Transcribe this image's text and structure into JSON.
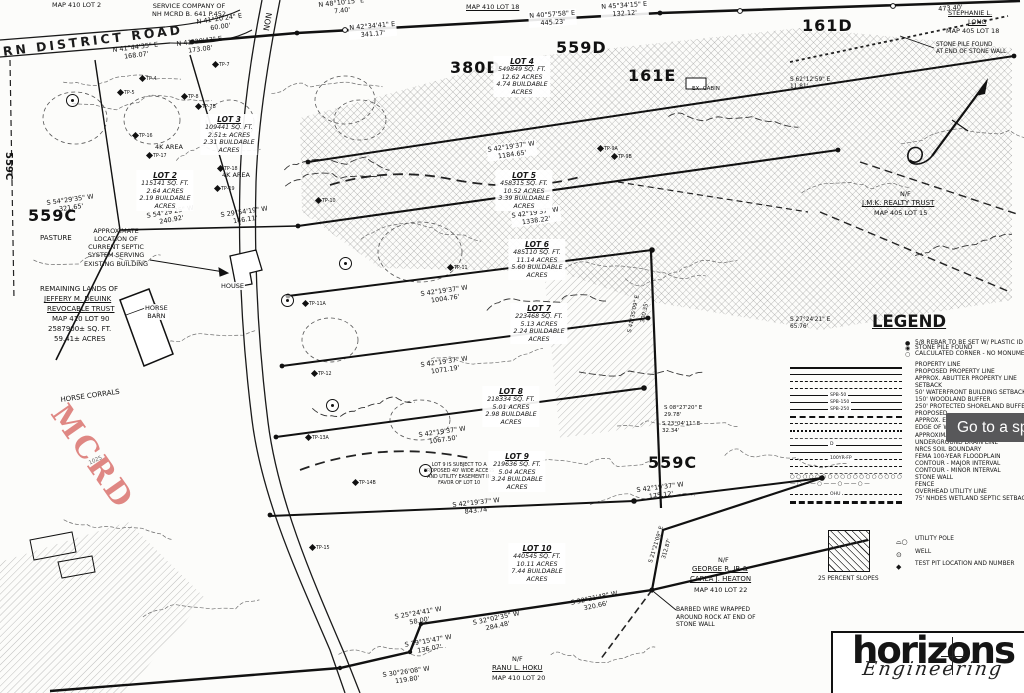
{
  "tooltip": {
    "text": "Go to a spe"
  },
  "watermark": {
    "text": "MCRD",
    "color": "#d96a66"
  },
  "logo": {
    "name": "horizons",
    "tagline": "Engineering"
  },
  "legend": {
    "title": "LEGEND",
    "point_items": [
      {
        "symbol": "rebar-icon",
        "label": "5/8 REBAR TO BE SET W/ PLASTIC ID CAP"
      },
      {
        "symbol": "stone-pile-icon",
        "label": "STONE PILE FOUND"
      },
      {
        "symbol": "calculated-corner-icon",
        "label": "CALCULATED CORNER - NO MONUMENT"
      }
    ],
    "line_items": [
      {
        "style": "property",
        "label": "PROPERTY LINE"
      },
      {
        "style": "proposed-property",
        "label": "PROPOSED PROPERTY LINE"
      },
      {
        "style": "abutter",
        "label": "APPROX. ABUTTER PROPERTY LINE"
      },
      {
        "style": "setback",
        "label": "SETBACK"
      },
      {
        "style": "spb50",
        "tag": "SPB-50",
        "label": "50' WATERFRONT BUILDING SETBACK"
      },
      {
        "style": "spb150",
        "tag": "SPB-150",
        "label": "150' WOODLAND BUFFER"
      },
      {
        "style": "spb250",
        "tag": "SPB-250",
        "label": "250' PROTECTED SHORELAND BUFFER"
      },
      {
        "style": "proposed2",
        "label": "PROPOSED"
      },
      {
        "style": "approx-e",
        "label": "APPROX. E"
      },
      {
        "style": "edge-w",
        "label": "EDGE OF W"
      },
      {
        "style": "approxima",
        "label": "APPROXIMA"
      },
      {
        "style": "drain",
        "tag": "D",
        "label": "UNDERGROUND DRAIN LINE"
      },
      {
        "style": "nrcs",
        "label": "NRCS SOIL BOUNDARY"
      },
      {
        "style": "floodplain",
        "tag": "100YR-FP",
        "label": "FEMA 100-YEAR FLOODPLAIN"
      },
      {
        "style": "contour-major",
        "label": "CONTOUR - MAJOR INTERVAL"
      },
      {
        "style": "contour-minor",
        "label": "CONTOUR - MINOR INTERVAL"
      },
      {
        "style": "stone-wall",
        "label": "STONE WALL"
      },
      {
        "style": "fence",
        "label": "FENCE"
      },
      {
        "style": "ohu",
        "tag": "OHU",
        "label": "OVERHEAD UTILITY LINE"
      },
      {
        "style": "wetland",
        "label": "75' NHDES WETLAND SEPTIC SETBACK"
      }
    ],
    "area_items": [
      {
        "symbol": "slope-hatch-icon",
        "label": "25 PERCENT SLOPES"
      }
    ],
    "symbol_items": [
      {
        "symbol": "utility-pole-icon",
        "label": "UTILITY POLE"
      },
      {
        "symbol": "well-icon",
        "label": "WELL"
      },
      {
        "symbol": "test-pit-icon",
        "label": "TEST PIT LOCATION AND NUMBER"
      }
    ]
  },
  "lot_blocks": [
    {
      "title": "LOT 2",
      "lines": [
        "115141 SQ. FT.",
        "2.64 ACRES",
        "2.19 BUILDABLE",
        "ACRES"
      ],
      "x": 165,
      "y": 170
    },
    {
      "title": "LOT 3",
      "lines": [
        "109441 SQ. FT.",
        "2.51± ACRES",
        "2.31 BUILDABLE",
        "ACRES"
      ],
      "x": 229,
      "y": 114
    },
    {
      "title": "LOT 4",
      "lines": [
        "549849 SQ. FT.",
        "12.62 ACRES",
        "4.74 BUILDABLE",
        "ACRES"
      ],
      "x": 522,
      "y": 56
    },
    {
      "title": "LOT 5",
      "lines": [
        "458315 SQ. FT.",
        "10.52 ACRES",
        "3.39 BUILDABLE",
        "ACRES"
      ],
      "x": 524,
      "y": 170
    },
    {
      "title": "LOT 6",
      "lines": [
        "485110 SQ. FT.",
        "11.14 ACRES",
        "5.60 BUILDABLE",
        "ACRES"
      ],
      "x": 537,
      "y": 239
    },
    {
      "title": "LOT 7",
      "lines": [
        "223468 SQ. FT.",
        "5.13 ACRES",
        "2.24 BUILDABLE",
        "ACRES"
      ],
      "x": 539,
      "y": 303
    },
    {
      "title": "LOT 8",
      "lines": [
        "218334 SQ. FT.",
        "5.01 ACRES",
        "2.98 BUILDABLE",
        "ACRES"
      ],
      "x": 511,
      "y": 386
    },
    {
      "title": "LOT 9",
      "lines": [
        "219636 SQ. FT.",
        "5.04 ACRES",
        "3.24 BUILDABLE",
        "ACRES"
      ],
      "x": 517,
      "y": 451
    },
    {
      "title": "LOT 10",
      "lines": [
        "440545 SQ. FT.",
        "10.11 ACRES",
        "7.44 BUILDABLE",
        "ACRES"
      ],
      "x": 537,
      "y": 543
    }
  ],
  "test_pits": [
    {
      "t": "TP-4",
      "x": 140,
      "y": 76
    },
    {
      "t": "TP-5",
      "x": 118,
      "y": 90
    },
    {
      "t": "TP-7",
      "x": 213,
      "y": 62
    },
    {
      "t": "TP-7B",
      "x": 196,
      "y": 104
    },
    {
      "t": "TP-8",
      "x": 182,
      "y": 94
    },
    {
      "t": "TP-9A",
      "x": 598,
      "y": 146
    },
    {
      "t": "TP-9B",
      "x": 612,
      "y": 154
    },
    {
      "t": "TP-10",
      "x": 316,
      "y": 198
    },
    {
      "t": "TP-11",
      "x": 448,
      "y": 265
    },
    {
      "t": "TP-11A",
      "x": 303,
      "y": 301
    },
    {
      "t": "TP-12",
      "x": 312,
      "y": 371
    },
    {
      "t": "TP-13A",
      "x": 306,
      "y": 435
    },
    {
      "t": "TP-14B",
      "x": 353,
      "y": 480
    },
    {
      "t": "TP-15",
      "x": 310,
      "y": 545
    },
    {
      "t": "TP-16",
      "x": 133,
      "y": 133
    },
    {
      "t": "TP-17",
      "x": 147,
      "y": 153
    },
    {
      "t": "TP-18",
      "x": 218,
      "y": 166
    },
    {
      "t": "TP-19",
      "x": 215,
      "y": 186
    }
  ],
  "wells": [
    [
      72,
      100
    ],
    [
      345,
      263
    ],
    [
      332,
      405
    ],
    [
      425,
      470
    ],
    [
      287,
      300
    ]
  ],
  "map_labels": [
    {
      "n": "parcel-map410lot2",
      "text": "MAP 410 LOT 2",
      "x": 52,
      "y": 1
    },
    {
      "n": "service-co-note",
      "text": "SERVICE COMPANY OF\nNH MCRD B. 641 P.452",
      "x": 152,
      "y": 2,
      "cls": "c"
    },
    {
      "n": "road-name",
      "text": "RN DISTRICT ROAD",
      "x": 2,
      "y": 44,
      "r": -7,
      "cls": "road"
    },
    {
      "n": "road-name-vertical",
      "text": "NON",
      "x": 262,
      "y": 30,
      "s": 8,
      "r": -80
    },
    {
      "n": "bearing",
      "text": "N 41°20'24\" E\n60.00'",
      "x": 196,
      "y": 18,
      "r": -8,
      "cls": "c"
    },
    {
      "n": "bearing",
      "text": "N 41°44'35\" E\n168.07'",
      "x": 112,
      "y": 46,
      "r": -7,
      "cls": "c"
    },
    {
      "n": "bearing",
      "text": "N 41°20'43\" E\n173.08'",
      "x": 176,
      "y": 40,
      "r": -7,
      "cls": "c"
    },
    {
      "n": "bearing",
      "text": "N 48°10'15\" E\n7.40'",
      "x": 318,
      "y": 1,
      "r": -6,
      "cls": "c"
    },
    {
      "n": "bearing",
      "text": "N 42°34'41\" E\n341.17'",
      "x": 348,
      "y": 24,
      "r": -5,
      "cls": "c wbg"
    },
    {
      "n": "bearing",
      "text": "N 40°57'58\" E\n445.23'",
      "x": 528,
      "y": 12,
      "r": -4,
      "cls": "c wbg"
    },
    {
      "n": "bearing",
      "text": "N 45°34'15\" E\n132.12'",
      "x": 600,
      "y": 3,
      "r": -4,
      "cls": "c wbg"
    },
    {
      "n": "distance",
      "text": "473.40'",
      "x": 938,
      "y": 5,
      "r": -4
    },
    {
      "n": "zone-380d",
      "text": "380D",
      "x": 450,
      "y": 58,
      "cls": "zone"
    },
    {
      "n": "zone-559d",
      "text": "559D",
      "x": 556,
      "y": 38,
      "cls": "zone"
    },
    {
      "n": "zone-161e",
      "text": "161E",
      "x": 628,
      "y": 66,
      "cls": "zone"
    },
    {
      "n": "zone-161d",
      "text": "161D",
      "x": 802,
      "y": 16,
      "cls": "zone"
    },
    {
      "n": "zone-559c-left",
      "text": "559C",
      "x": 28,
      "y": 206,
      "cls": "zone"
    },
    {
      "n": "zone-559c-vert",
      "text": "559C",
      "x": 14,
      "y": 152,
      "s": 10,
      "r": 90,
      "cls": "b"
    },
    {
      "n": "zone-559c-right",
      "text": "559C",
      "x": 648,
      "y": 453,
      "cls": "zone"
    },
    {
      "n": "abutter-long-1",
      "text": "STEPHANIE L.",
      "x": 948,
      "y": 9,
      "cls": "u"
    },
    {
      "n": "abutter-long-2",
      "text": "LONG",
      "x": 968,
      "y": 18,
      "cls": "u"
    },
    {
      "n": "abutter-long-3",
      "text": "MAP 405 LOT 18",
      "x": 946,
      "y": 27
    },
    {
      "n": "stone-pile-note",
      "text": "STONE PILE FOUND\nAT END OF STONE WALL",
      "x": 936,
      "y": 42,
      "s": 5.8
    },
    {
      "n": "abutter-jmk-1",
      "text": "N/F",
      "x": 900,
      "y": 190
    },
    {
      "n": "abutter-jmk-2",
      "text": "J.M.K. REALTY TRUST",
      "x": 862,
      "y": 199,
      "s": 7,
      "cls": "u"
    },
    {
      "n": "abutter-jmk-3",
      "text": "MAP 405 LOT 15",
      "x": 874,
      "y": 209
    },
    {
      "n": "parcel-map410lot18",
      "text": "MAP 410 LOT 18",
      "x": 466,
      "y": 3,
      "cls": "u"
    },
    {
      "n": "cabin-label",
      "text": "EX. CABIN",
      "x": 692,
      "y": 86,
      "s": 5.5
    },
    {
      "n": "bearing",
      "text": "S 62°12'59\" E\n11.81'",
      "x": 790,
      "y": 77,
      "s": 5.8
    },
    {
      "n": "bearing",
      "text": "S 27°24'21\" E\n65.76'",
      "x": 790,
      "y": 317,
      "s": 5.8
    },
    {
      "n": "bearing",
      "text": "S 08°27'20\" E\n29.78'",
      "x": 664,
      "y": 405,
      "s": 5.5
    },
    {
      "n": "bearing",
      "text": "S 23°04'11\" E\n32.34'",
      "x": 662,
      "y": 421,
      "s": 5.5
    },
    {
      "n": "bearing",
      "text": "S 41°35'09\" E",
      "x": 627,
      "y": 332,
      "s": 5.5,
      "r": -78
    },
    {
      "n": "distance",
      "text": "300.35'",
      "x": 640,
      "y": 322,
      "s": 5.5,
      "r": -78
    },
    {
      "n": "pasture-label",
      "text": "PASTURE",
      "x": 40,
      "y": 234,
      "s": 7
    },
    {
      "n": "septic-note",
      "text": "APPROXIMATE\nLOCATION OF\nCURRENT SEPTIC\nSYSTEM SERVING\nEXISTING BUILDING",
      "x": 84,
      "y": 227,
      "cls": "c"
    },
    {
      "n": "remaining-lands-1",
      "text": "REMAINING LANDS OF",
      "x": 40,
      "y": 285,
      "s": 7
    },
    {
      "n": "remaining-lands-2",
      "text": "JEFFERY M. DEUINK",
      "x": 44,
      "y": 295,
      "s": 7,
      "cls": "u"
    },
    {
      "n": "remaining-lands-3",
      "text": "REVOCABLE TRUST",
      "x": 47,
      "y": 305,
      "s": 7,
      "cls": "u"
    },
    {
      "n": "remaining-lands-4",
      "text": "MAP 410 LOT 90",
      "x": 52,
      "y": 315,
      "s": 7
    },
    {
      "n": "remaining-lands-5",
      "text": "2587900± SQ. FT.",
      "x": 48,
      "y": 325,
      "s": 7
    },
    {
      "n": "remaining-lands-6",
      "text": "59.41± ACRES",
      "x": 54,
      "y": 335,
      "s": 7
    },
    {
      "n": "barn-label",
      "text": "HORSE\nBARN",
      "x": 144,
      "y": 304,
      "cls": "c wbg"
    },
    {
      "n": "house-label",
      "text": "HOUSE",
      "x": 220,
      "y": 282,
      "cls": "wbg"
    },
    {
      "n": "corrals-label",
      "text": "HORSE CORRALS",
      "x": 60,
      "y": 396,
      "s": 7,
      "r": -8
    },
    {
      "n": "abutter-heaton-1",
      "text": "N/F",
      "x": 718,
      "y": 556
    },
    {
      "n": "abutter-heaton-2",
      "text": "GEORGE R. JR &",
      "x": 692,
      "y": 565,
      "s": 7,
      "cls": "u"
    },
    {
      "n": "abutter-heaton-3",
      "text": "CARLA J. HEATON",
      "x": 690,
      "y": 575,
      "s": 7,
      "cls": "u"
    },
    {
      "n": "abutter-heaton-4",
      "text": "MAP 410 LOT 22",
      "x": 694,
      "y": 586
    },
    {
      "n": "barbed-wire-note",
      "text": "BARBED WIRE WRAPPED\nAROUND ROCK AT END OF\nSTONE WALL",
      "x": 676,
      "y": 606,
      "s": 6
    },
    {
      "n": "abutter-ranu-1",
      "text": "N/F",
      "x": 512,
      "y": 655
    },
    {
      "n": "abutter-ranu-2",
      "text": "RANU L. HOKU",
      "x": 492,
      "y": 664,
      "s": 7,
      "cls": "u"
    },
    {
      "n": "abutter-ranu-3",
      "text": "MAP 410 LOT 20",
      "x": 492,
      "y": 674
    },
    {
      "n": "bearing",
      "text": "S 42°19'37\" W\n1184.65'",
      "x": 486,
      "y": 146,
      "r": -8,
      "cls": "c wbg"
    },
    {
      "n": "bearing",
      "text": "S 42°19'37\" W\n1338.22'",
      "x": 510,
      "y": 212,
      "r": -8,
      "cls": "c wbg"
    },
    {
      "n": "bearing",
      "text": "S 42°19'37\" W\n1004.76'",
      "x": 420,
      "y": 290,
      "r": -8,
      "cls": "c"
    },
    {
      "n": "bearing",
      "text": "S 42°19'37\" W\n1071.19'",
      "x": 420,
      "y": 361,
      "r": -8,
      "cls": "c"
    },
    {
      "n": "bearing",
      "text": "S 42°19'37\" W\n1067.50'",
      "x": 418,
      "y": 431,
      "r": -8,
      "cls": "c"
    },
    {
      "n": "bearing",
      "text": "S 42°19'37\" W\n843.74'",
      "x": 452,
      "y": 501,
      "r": -6,
      "cls": "c"
    },
    {
      "n": "bearing",
      "text": "S 42°19'37\" W\n175.12'",
      "x": 636,
      "y": 486,
      "r": -7,
      "cls": "c"
    },
    {
      "n": "bearing",
      "text": "S 54°29'25\" W\n240.92'",
      "x": 146,
      "y": 212,
      "r": -10,
      "cls": "c"
    },
    {
      "n": "bearing",
      "text": "S 29°54'19\" W\n146.11'",
      "x": 220,
      "y": 211,
      "r": -8,
      "cls": "c"
    },
    {
      "n": "bearing",
      "text": "S 54°29'35\" W\n321.65'",
      "x": 46,
      "y": 199,
      "r": -8,
      "cls": "c"
    },
    {
      "n": "bearing",
      "text": "S 25°24'41\" W\n58.00'",
      "x": 394,
      "y": 613,
      "r": -10,
      "cls": "c"
    },
    {
      "n": "bearing",
      "text": "S 39°15'47\" W\n136.07'",
      "x": 404,
      "y": 641,
      "r": -10,
      "cls": "c"
    },
    {
      "n": "bearing",
      "text": "S 32°02'35\" W\n284.48'",
      "x": 472,
      "y": 619,
      "r": -12,
      "cls": "c"
    },
    {
      "n": "bearing",
      "text": "S 32°21'48\" W\n320.66'",
      "x": 570,
      "y": 599,
      "r": -12,
      "cls": "c"
    },
    {
      "n": "bearing",
      "text": "S 30°26'08\" W\n119.80'",
      "x": 382,
      "y": 671,
      "r": -8,
      "cls": "c"
    },
    {
      "n": "bearing",
      "text": "S 21°21'09\" E",
      "x": 648,
      "y": 562,
      "s": 5.5,
      "r": -73
    },
    {
      "n": "distance",
      "text": "312.87'",
      "x": 661,
      "y": 558,
      "s": 5.5,
      "r": -73
    },
    {
      "n": "contour-elev",
      "text": "1025",
      "x": 88,
      "y": 461,
      "s": 5.5,
      "r": -25,
      "cls": "gray"
    },
    {
      "n": "lot9-easement-note",
      "text": "LOT 9 IS SUBJECT TO A\nPROPOSED 40' WIDE ACCESS\nAND UTILITY EASEMENT IN\nFAVOR OF LOT 10",
      "x": 424,
      "y": 463,
      "s": 4.8,
      "cls": "c"
    },
    {
      "n": "4k-area-label",
      "text": "4K AREA",
      "x": 155,
      "y": 143
    },
    {
      "n": "4k-area-label",
      "text": "4K AREA",
      "x": 222,
      "y": 171
    }
  ]
}
